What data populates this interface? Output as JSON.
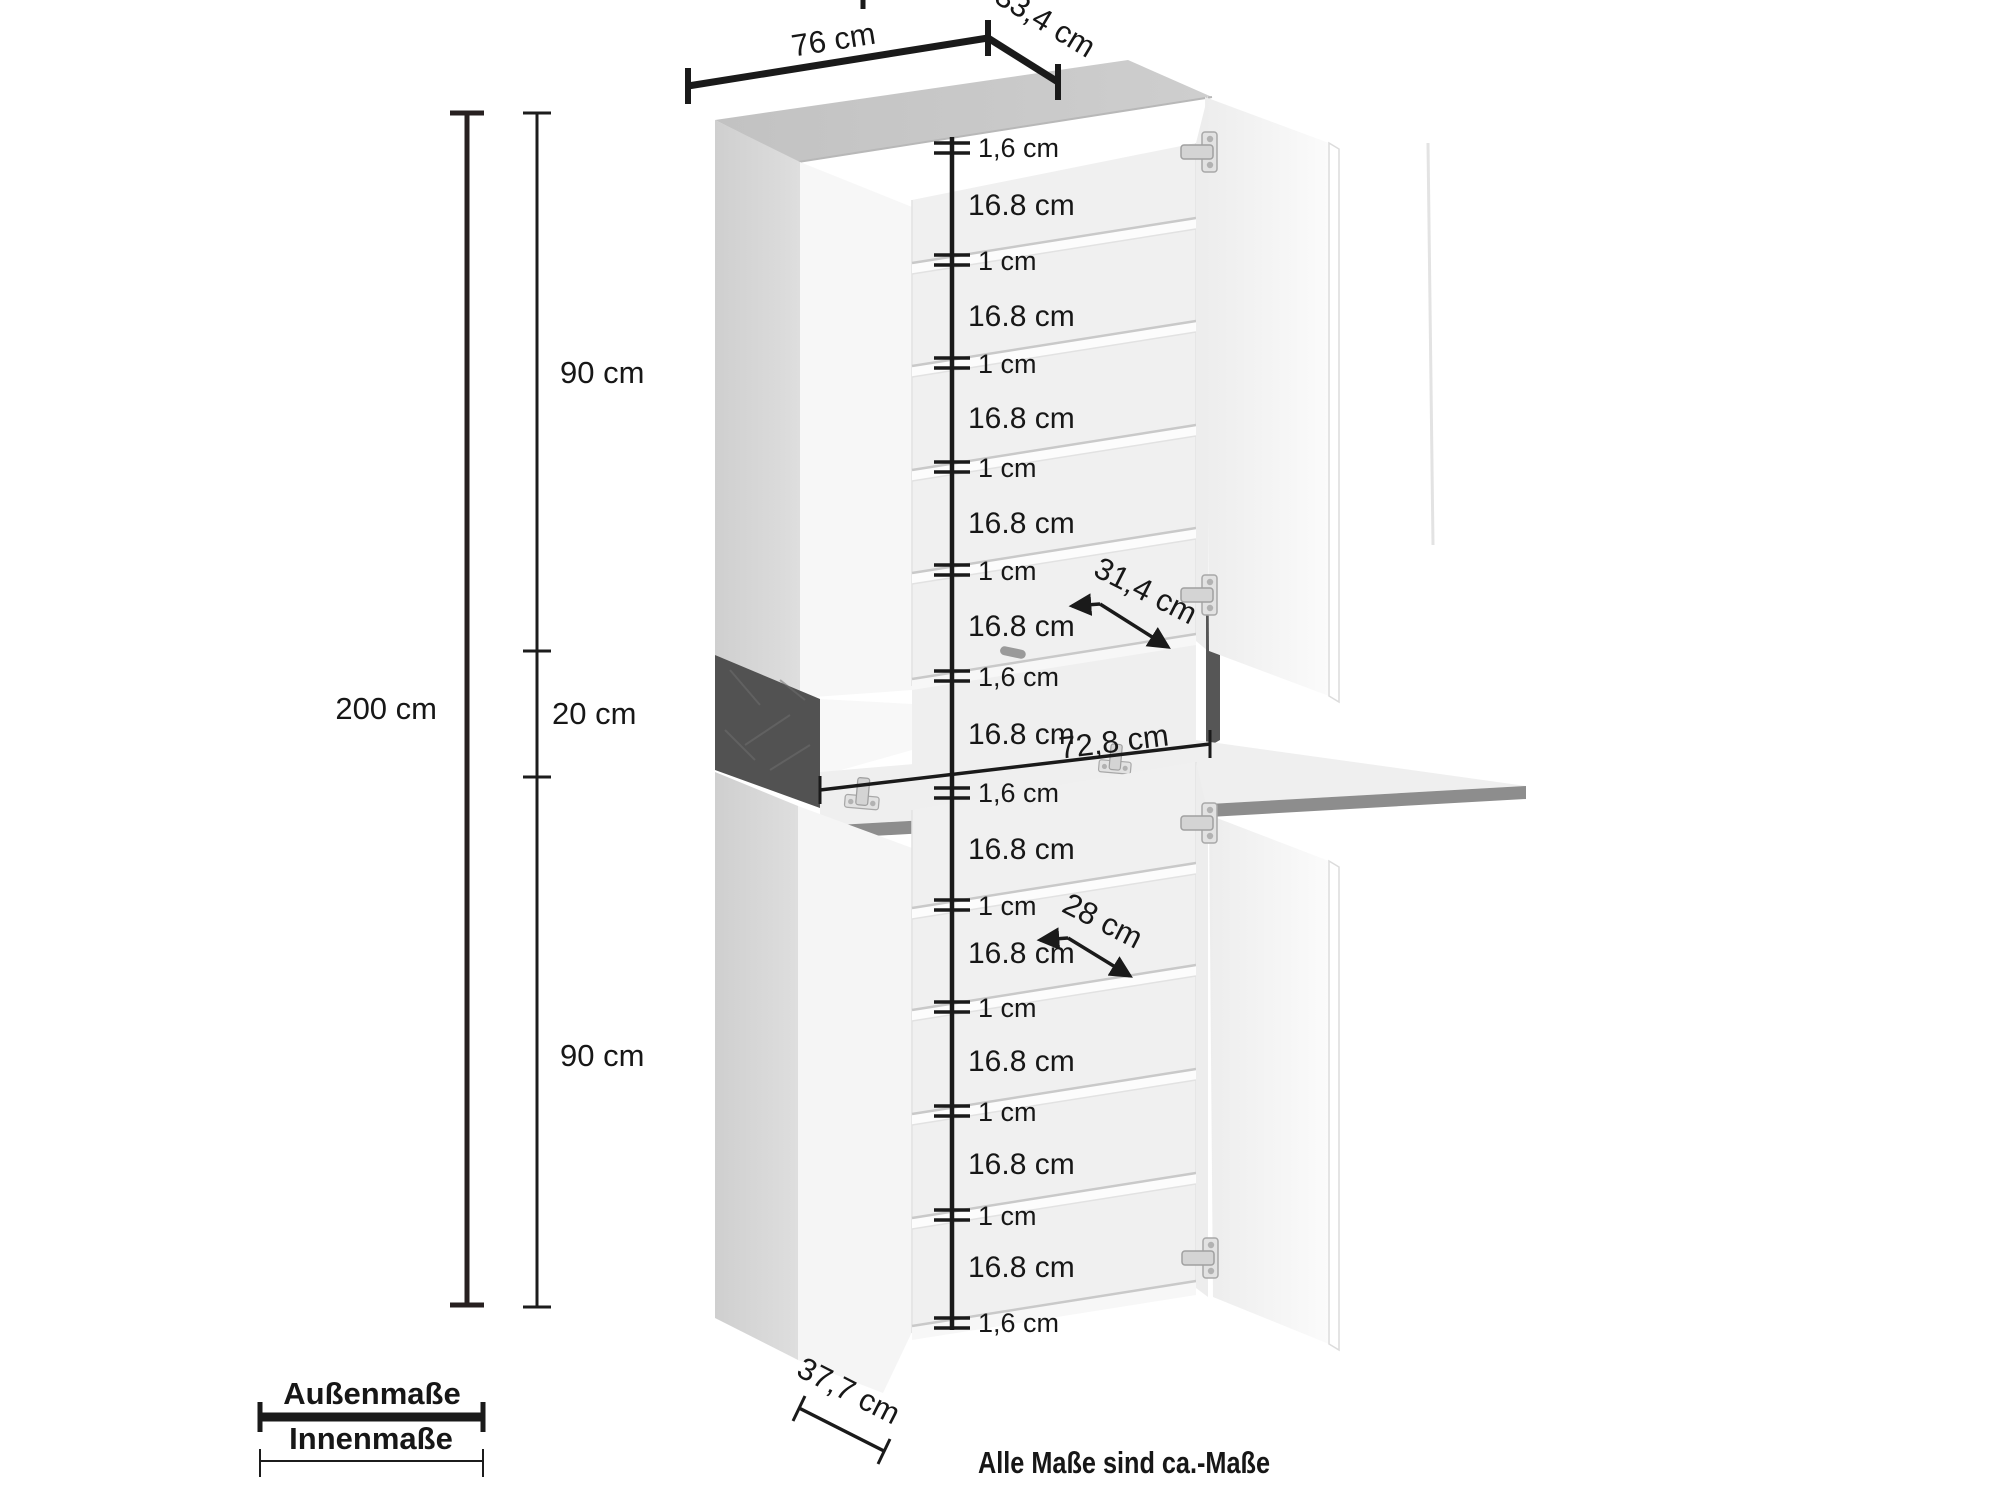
{
  "footnote": "Alle Maße sind ca.-Maße",
  "legend": {
    "outer_label": "Außenmaße",
    "inner_label": "Innenmaße"
  },
  "outer_dimensions": {
    "width": "76 cm",
    "depth": "33,4 cm",
    "total_height": "200 cm",
    "upper_module_height": "90 cm",
    "middle_module_height": "20 cm",
    "lower_module_height": "90 cm"
  },
  "inner_dimensions": {
    "upper_compartment_depth": "31,4 cm",
    "middle_inner_width": "72,8 cm",
    "lower_compartment_depth": "28 cm",
    "door_width": "37,7 cm"
  },
  "measure_chain": [
    "1,6 cm",
    "16.8 cm",
    "1 cm",
    "16.8 cm",
    "1 cm",
    "16.8 cm",
    "1 cm",
    "16.8 cm",
    "1 cm",
    "16.8 cm",
    "1,6 cm",
    "16.8 cm",
    "1,6 cm",
    "16.8 cm",
    "1 cm",
    "16.8 cm",
    "1 cm",
    "16.8 cm",
    "1 cm",
    "16.8 cm",
    "1 cm",
    "16.8 cm",
    "1,6 cm"
  ],
  "colors": {
    "dimension_line": "#1a1a1a",
    "total_height_line": "#272020",
    "note_text": "#4f4f4f",
    "cabinet_top": "#c7c7c7",
    "cabinet_side": "#d6d6d6",
    "cabinet_dark_panel": "#525252",
    "flap_edge": "#8d8d8d"
  }
}
